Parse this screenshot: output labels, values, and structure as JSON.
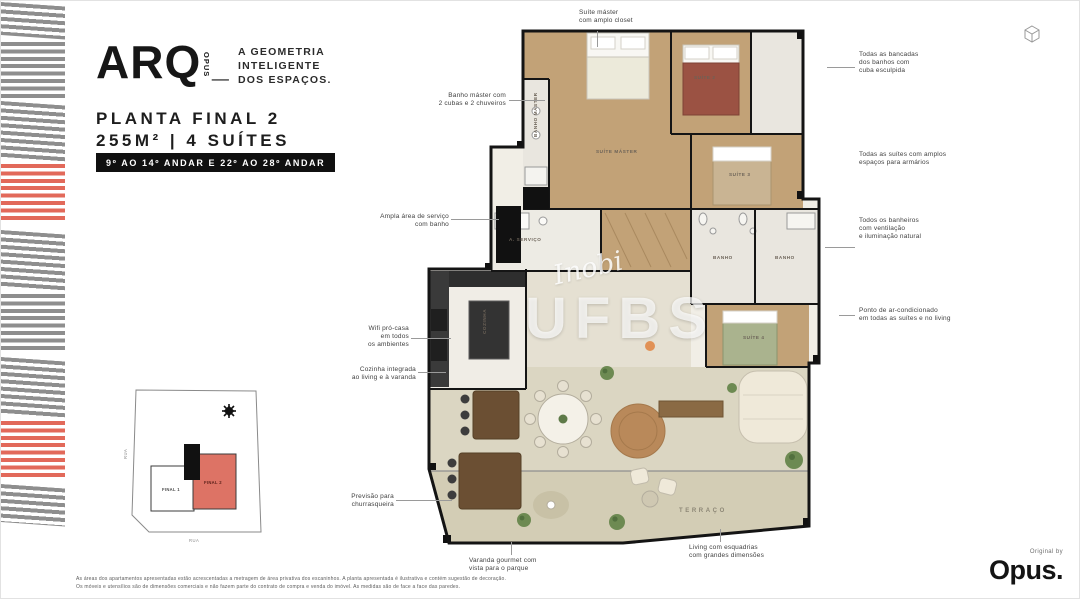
{
  "logo": {
    "wordmark": "ARQ",
    "vertical": "OPUS",
    "underscore": "_",
    "tagline": "A GEOMETRIA\nINTELIGENTE\nDOS ESPAÇOS."
  },
  "header": {
    "title": "PLANTA FINAL 2",
    "subtitle": "255M² | 4 SUÍTES",
    "badge": "9º AO 14º ANDAR E 22º AO 28º ANDAR"
  },
  "annotations": {
    "top": "Suíte máster\ncom amplo closet",
    "left": [
      {
        "text": "Banho máster com\n2 cubas e 2 chuveiros"
      },
      {
        "text": "Ampla área de serviço\ncom banho"
      },
      {
        "text": "Wifi pró-casa\nem todos\nos ambientes"
      },
      {
        "text": "Cozinha integrada\nao living e à varanda"
      },
      {
        "text": "Previsão para\nchurrasqueira"
      }
    ],
    "right": [
      {
        "text": "Todas as bancadas\ndos banhos com\ncuba esculpida"
      },
      {
        "text": "Todas as suítes com amplos\nespaços para armários"
      },
      {
        "text": "Todos os banheiros\ncom ventilação\ne iluminação natural"
      },
      {
        "text": "Ponto de ar-condicionado\nem todas as suítes e no living"
      }
    ],
    "bottom": [
      {
        "text": "Varanda gourmet com\nvista para o parque"
      },
      {
        "text": "Living com esquadrias\ncom grandes dimensões"
      }
    ]
  },
  "plan": {
    "labels": {
      "banho_master": "BANHO MÁSTER",
      "suite_master": "SUÍTE MÁSTER",
      "suite2": "SUÍTE 2",
      "suite3": "SUÍTE 3",
      "suite4": "SUÍTE 4",
      "servico": "A. SERVIÇO",
      "banho1": "BANHO",
      "banho2": "BANHO",
      "cozinha": "COZINHA",
      "terraco": "TERRAÇO"
    },
    "watermark": {
      "script": "Inobi",
      "main": "UFBS"
    }
  },
  "site_map": {
    "final1": "FINAL 1",
    "final2": "FINAL 2",
    "street_left": "RUA",
    "street_bottom": "RUA"
  },
  "footer": {
    "disclaimer": "As áreas dos apartamentos apresentadas estão acrescentadas a metragem de área privativa dos escaninhos. A planta apresentada é ilustrativa e contém sugestão de decoração.\nOs móveis e utensílios são de dimensões comerciais e não fazem parte do contrato de compra e venda do imóvel. As medidas são de face a face das paredes.",
    "credit": "Original by",
    "brand": "Opus."
  },
  "colors": {
    "accent_red": "#dd7365",
    "stripe_gray": "#8e8e8e",
    "stripe_red": "#e2695a",
    "wood": "#c2a277",
    "living_floor": "#dbd6c2",
    "terrace_floor": "#d3cdb5",
    "wall": "#141414"
  }
}
